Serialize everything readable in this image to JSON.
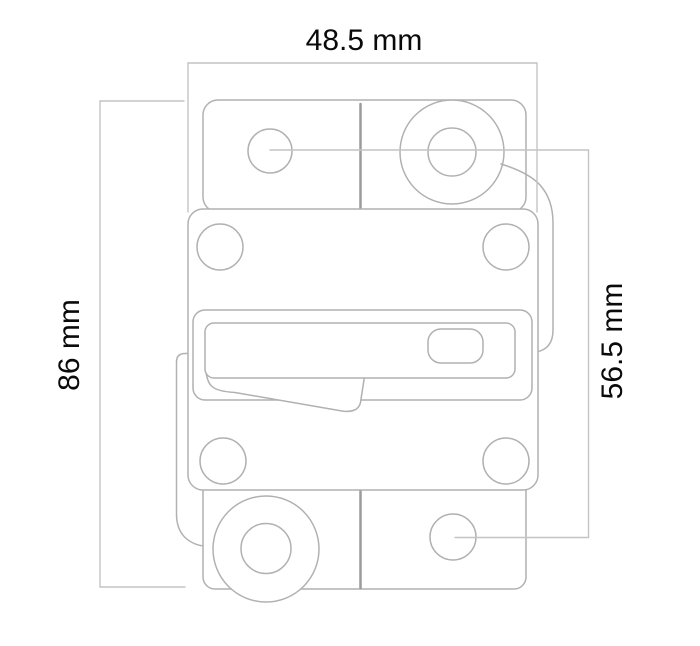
{
  "drawing": {
    "title": "circuit breaker outline dimension drawing",
    "view": "front view"
  },
  "dimensions": {
    "width": {
      "label": "48.5 mm"
    },
    "height": {
      "label": "86 mm"
    },
    "hole_spacing": {
      "label": "56.5 mm"
    }
  },
  "colors": {
    "background": "#ffffff",
    "outline": "#b1b1b1",
    "divider": "#9b9b9b",
    "dimension_line": "#c4c4c4",
    "text": "#0a0a0a"
  }
}
